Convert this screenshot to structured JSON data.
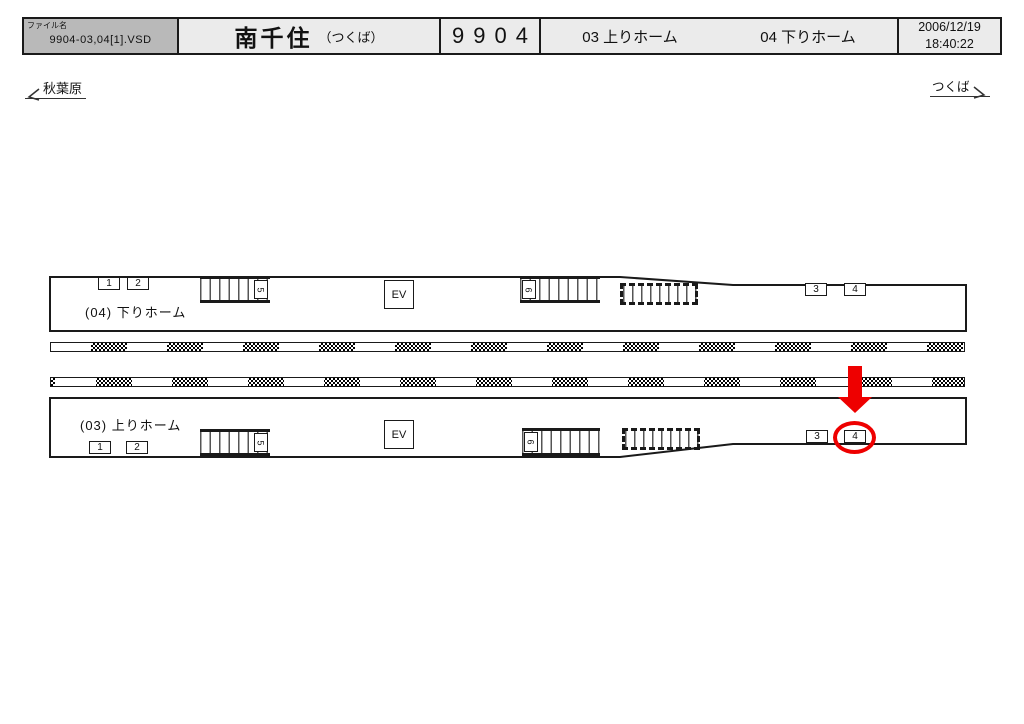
{
  "title_block": {
    "file_label": "ファイル名",
    "file_name": "9904-03,04[1].VSD",
    "station_name": "南千住",
    "station_note": "（つくば）",
    "number": "9904",
    "platform_up_label": "03 上りホーム",
    "platform_down_label": "04 下りホーム",
    "date": "2006/12/19",
    "time": "18:40:22"
  },
  "directions": {
    "left_terminus": "秋葉原",
    "right_terminus": "つくば"
  },
  "platform_down": {
    "name_label": "(04)  下りホーム",
    "position_1": "1",
    "position_2": "2",
    "position_3": "3",
    "position_4": "4",
    "stair_left_number": "5",
    "stair_center_number": "6",
    "elevator_label": "EV"
  },
  "platform_up": {
    "name_label": "(03)  上りホーム",
    "position_1": "1",
    "position_2": "2",
    "position_3": "3",
    "position_4": "4",
    "stair_left_number": "5",
    "stair_center_number": "6",
    "elevator_label": "EV",
    "highlighted_position": "4"
  },
  "colors": {
    "highlight": "#ee0000",
    "title_file_bg": "#b9b9b9",
    "title_cell_bg": "#ebebeb"
  }
}
